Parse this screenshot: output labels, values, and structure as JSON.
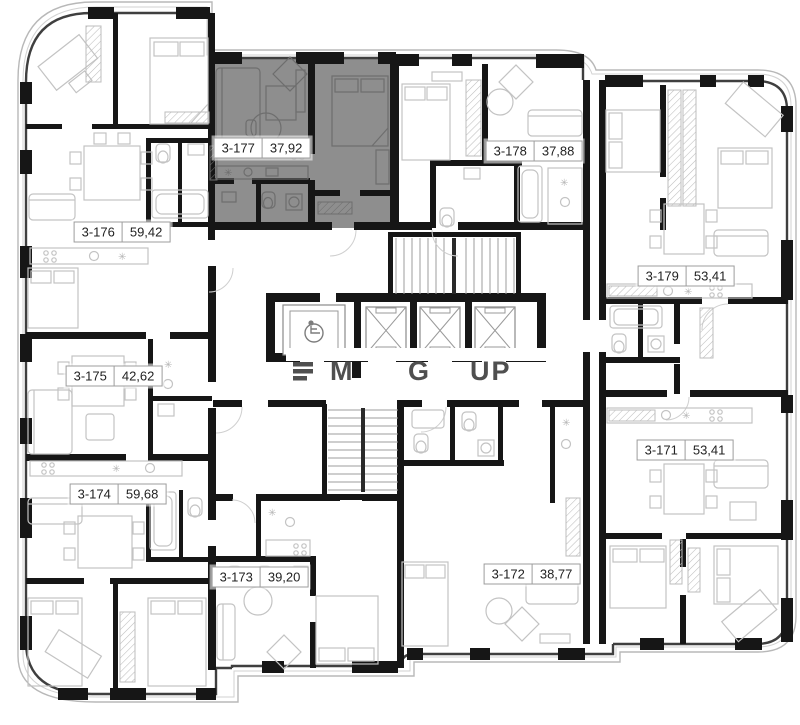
{
  "plan": {
    "units": [
      {
        "id": "3-171",
        "area": "53,41",
        "cx": 685,
        "cy": 450,
        "highlighted": false
      },
      {
        "id": "3-172",
        "area": "38,77",
        "cx": 532,
        "cy": 574,
        "highlighted": false
      },
      {
        "id": "3-173",
        "area": "39,20",
        "cx": 260,
        "cy": 577,
        "highlighted": false
      },
      {
        "id": "3-174",
        "area": "59,68",
        "cx": 118,
        "cy": 494,
        "highlighted": false
      },
      {
        "id": "3-175",
        "area": "42,62",
        "cx": 114,
        "cy": 376,
        "highlighted": false
      },
      {
        "id": "3-176",
        "area": "59,42",
        "cx": 122,
        "cy": 232,
        "highlighted": false
      },
      {
        "id": "3-177",
        "area": "37,92",
        "cx": 262,
        "cy": 148,
        "highlighted": true
      },
      {
        "id": "3-178",
        "area": "37,88",
        "cx": 534,
        "cy": 151,
        "highlighted": false
      },
      {
        "id": "3-179",
        "area": "53,41",
        "cx": 686,
        "cy": 276,
        "highlighted": false
      }
    ],
    "highlight_fill": "#8e8e8e",
    "wall_color": "#161616",
    "watermark_fragments": {
      "f1": "M",
      "f2": "G",
      "f3": "UP"
    }
  }
}
